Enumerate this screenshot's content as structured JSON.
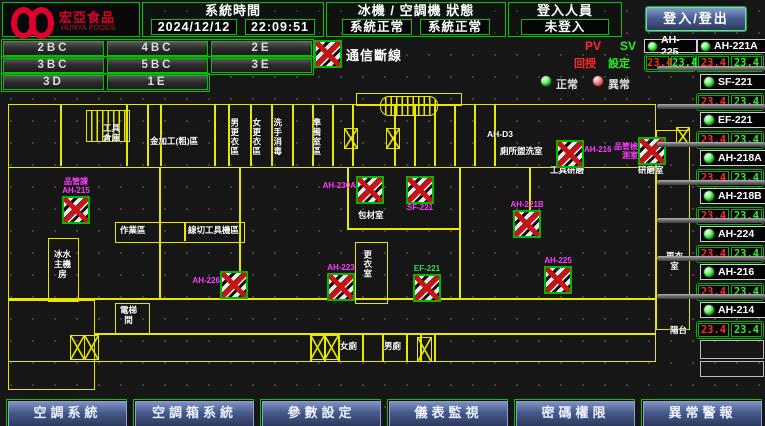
{
  "header": {
    "logo_cn": "宏亞食品",
    "logo_en": "HUNYA FOODS",
    "system_time_label": "系統時間",
    "date": "2024/12/12",
    "time": "22:09:51",
    "status_label": "冰機 / 空調機 狀態",
    "chiller_status": "系統正常",
    "ac_status": "系統正常",
    "login_label": "登入人員",
    "login_status": "未登入",
    "login_button": "登入/登出"
  },
  "floors": [
    "2BC",
    "4BC",
    "2E",
    "3BC",
    "5BC",
    "3E",
    "3D",
    "1E"
  ],
  "legend": {
    "comm_error": "通信斷線",
    "pv": "PV",
    "sv": "SV",
    "feedback": "回授",
    "setpoint": "設定",
    "normal": "正常",
    "abnormal": "異常"
  },
  "equipment_top": [
    {
      "name": "AH-225",
      "pv": "23.4",
      "sv": "23.4"
    },
    {
      "name": "AH-221A",
      "pv": "23.4",
      "sv": "23.4"
    }
  ],
  "equipment_list": [
    {
      "name": "SF-221",
      "pv": "23.4",
      "sv": "23.4"
    },
    {
      "name": "EF-221",
      "pv": "23.4",
      "sv": "23.4"
    },
    {
      "name": "AH-218A",
      "pv": "23.4",
      "sv": "23.4"
    },
    {
      "name": "AH-218B",
      "pv": "23.4",
      "sv": "23.4"
    },
    {
      "name": "AH-224",
      "pv": "23.4",
      "sv": "23.4"
    },
    {
      "name": "AH-216",
      "pv": "23.4",
      "sv": "23.4"
    },
    {
      "name": "AH-214",
      "pv": "23.4",
      "sv": "23.4"
    }
  ],
  "map": {
    "units": [
      {
        "id": "AH-215",
        "label": "品管課\nAH-215",
        "x": 62,
        "y": 196,
        "pos": "top",
        "color": "#ff3cff"
      },
      {
        "id": "AH-226",
        "label": "AH-226",
        "x": 220,
        "y": 271,
        "pos": "left",
        "color": "#ff3cff"
      },
      {
        "id": "AH-230A",
        "label": "AH-230A",
        "x": 356,
        "y": 176,
        "pos": "left",
        "color": "#ff3cff"
      },
      {
        "id": "SF-221",
        "label": "SF-221",
        "x": 406,
        "y": 176,
        "pos": "bottom",
        "color": "#ff3cff"
      },
      {
        "id": "AH-221B",
        "label": "AH-221B",
        "x": 513,
        "y": 210,
        "pos": "top",
        "color": "#ff3cff"
      },
      {
        "id": "AH-216",
        "label": "AH-216",
        "x": 556,
        "y": 140,
        "pos": "right",
        "color": "#ff3cff"
      },
      {
        "id": "AH-218",
        "label": "品管檢\n測室",
        "x": 638,
        "y": 137,
        "pos": "left",
        "color": "#ff3cff"
      },
      {
        "id": "AH-223",
        "label": "AH-223",
        "x": 327,
        "y": 273,
        "pos": "top",
        "color": "#ff3cff"
      },
      {
        "id": "EF-221",
        "label": "EF-221",
        "x": 413,
        "y": 274,
        "pos": "top",
        "color": "#33dd55"
      },
      {
        "id": "AH-225",
        "label": "AH-225",
        "x": 544,
        "y": 266,
        "pos": "top",
        "color": "#ff3cff"
      }
    ],
    "rooms": [
      {
        "t": "工具\n倉庫",
        "x": 103,
        "y": 124
      },
      {
        "t": "金加工(粗)區",
        "x": 150,
        "y": 137
      },
      {
        "t": "男更衣區",
        "x": 229,
        "y": 118,
        "v": true
      },
      {
        "t": "女更衣區",
        "x": 251,
        "y": 118,
        "v": true
      },
      {
        "t": "洗手消毒",
        "x": 272,
        "y": 118,
        "v": true
      },
      {
        "t": "準備室區",
        "x": 311,
        "y": 118,
        "v": true
      },
      {
        "t": "AH-D3",
        "x": 487,
        "y": 130
      },
      {
        "t": "廁所盥洗室",
        "x": 500,
        "y": 147
      },
      {
        "t": "工具研磨",
        "x": 550,
        "y": 166
      },
      {
        "t": "研磨室",
        "x": 638,
        "y": 166
      },
      {
        "t": "作業區",
        "x": 120,
        "y": 226
      },
      {
        "t": "線切工具機區",
        "x": 188,
        "y": 226
      },
      {
        "t": "包材室",
        "x": 358,
        "y": 211
      },
      {
        "t": "更衣室",
        "x": 362,
        "y": 250,
        "v": true
      },
      {
        "t": "冰水\n主機\n房",
        "x": 54,
        "y": 250
      },
      {
        "t": "電梯\n間",
        "x": 120,
        "y": 306
      },
      {
        "t": "女廁",
        "x": 340,
        "y": 342
      },
      {
        "t": "男廁",
        "x": 384,
        "y": 342
      },
      {
        "t": "更衣\n室",
        "x": 666,
        "y": 252
      },
      {
        "t": "陽台",
        "x": 670,
        "y": 326
      }
    ]
  },
  "toolbar": [
    "空調系統",
    "空調箱系統",
    "參數設定",
    "儀表監視",
    "密碼權限",
    "異常警報"
  ],
  "colors": {
    "accent_green": "#00c400",
    "alarm_red": "#ff2828",
    "setpoint_green": "#2aee2a",
    "magenta": "#ff3cff",
    "wall_yellow": "#e8e800",
    "toolbar_blue": "#46598c"
  }
}
